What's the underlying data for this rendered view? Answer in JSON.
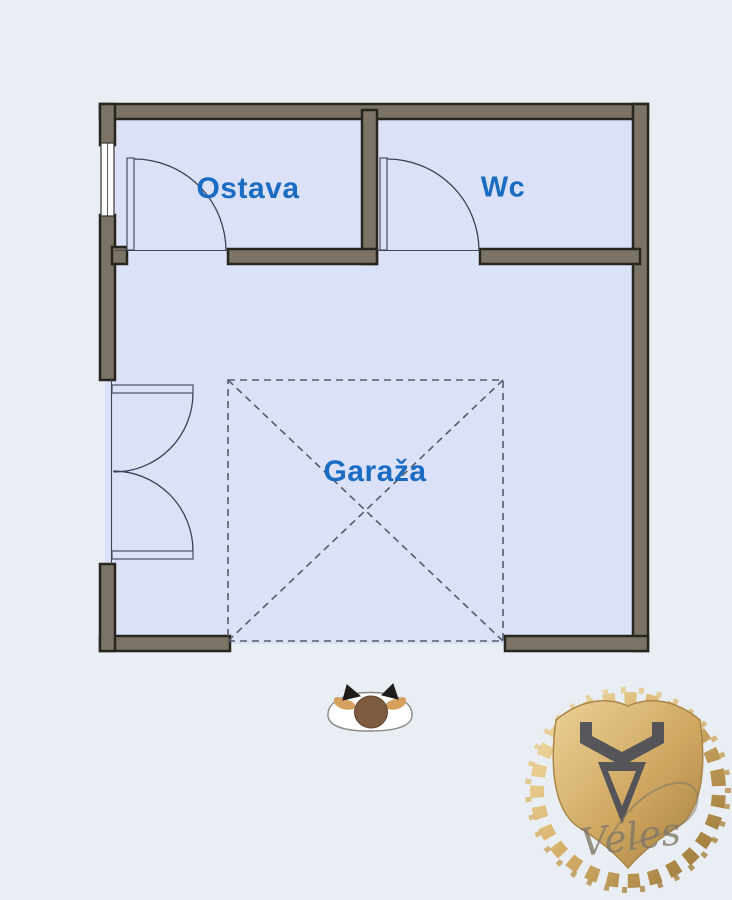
{
  "scene": {
    "description": "Apartment garage floor plan with storage room, WC and garage parking marker, pet figure and gold Veles emblem"
  },
  "colors": {
    "background": "#e8eef3",
    "room_fill": "#dbe1f8",
    "wall_fill": "#7b7466",
    "wall_edge": "#26261f",
    "plan_line": "#3c4258",
    "dash_line": "#565b6b",
    "label_blue": "#1a6cc2",
    "logo_gold_light": "#f2dda6",
    "logo_gold_dark": "#9d7736",
    "logo_symbol": "#3e4250",
    "pet_brown": "#7d5b3e",
    "pet_tan": "#d6a05f"
  },
  "rooms": {
    "ostava": {
      "label": "Ostava"
    },
    "wc": {
      "label": "Wc"
    },
    "garaza": {
      "label": "Garaža"
    }
  },
  "logo": {
    "brand": "Veles"
  },
  "icons": {
    "pet": "cat-top-view-icon",
    "parking": "parking-space-dashed-cross",
    "emblem": "veles-shield-wreath-icon"
  }
}
